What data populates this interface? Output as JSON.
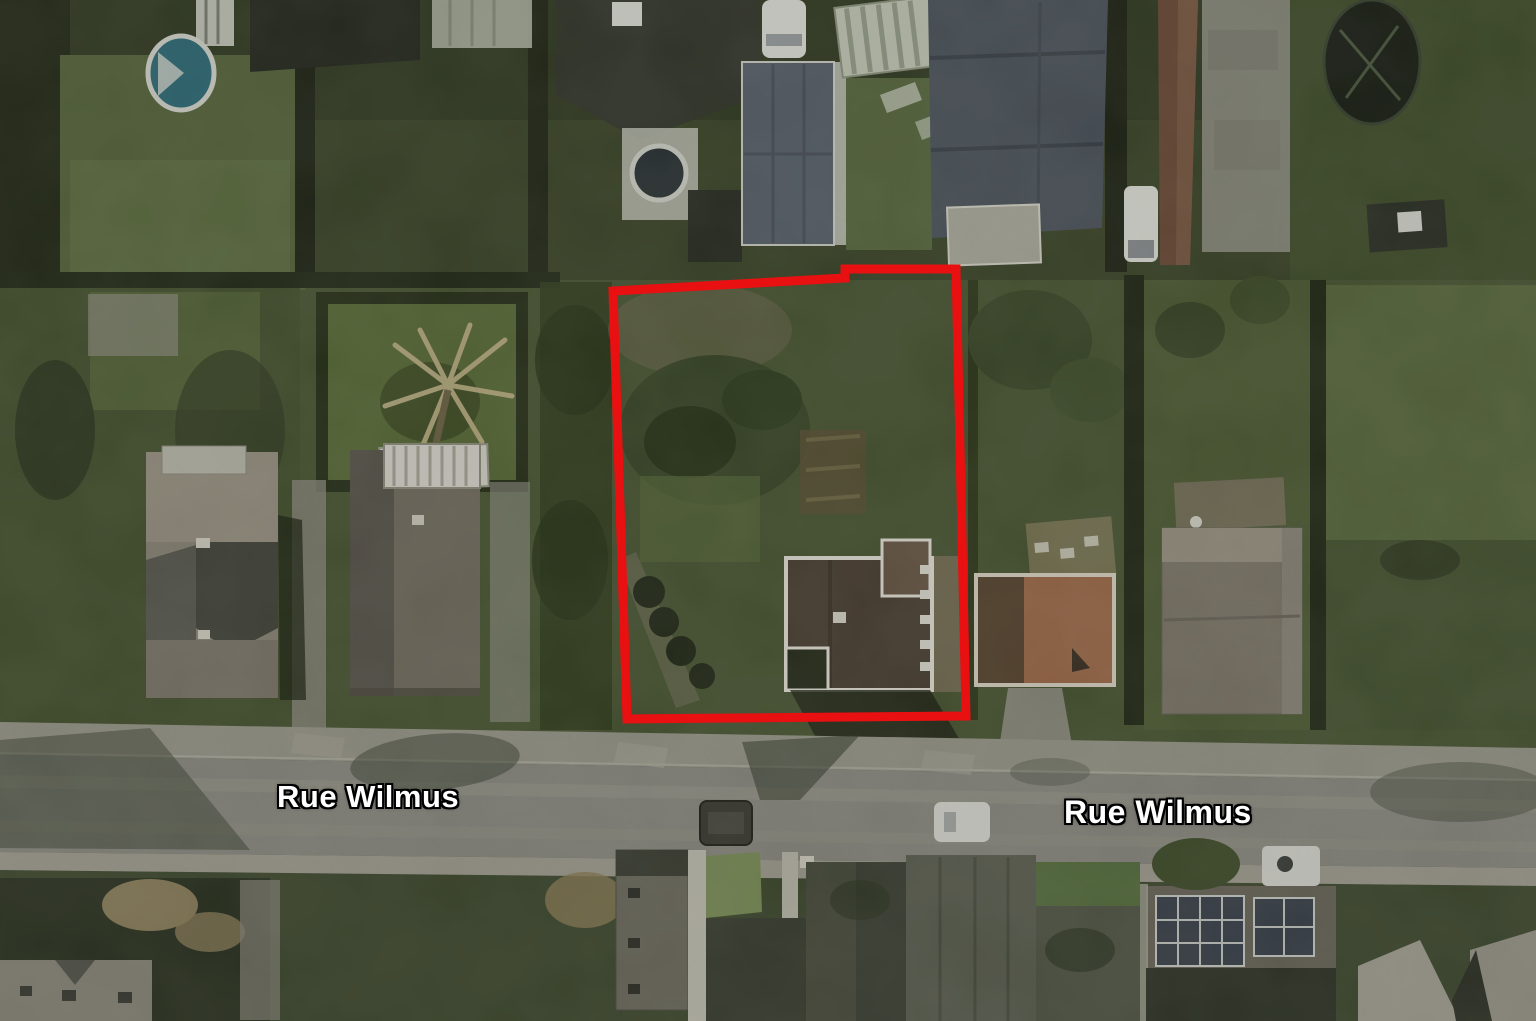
{
  "map": {
    "view_type": "satellite-aerial",
    "location_labels": [
      {
        "id": "west",
        "text": "Rue Wilmus"
      },
      {
        "id": "east",
        "text": "Rue Wilmus"
      }
    ],
    "boundary": {
      "name": "highlighted-property-boundary",
      "points": "613,291 845,278 845,269 956,269 966,716 627,719",
      "color": "#e81010"
    },
    "palette": {
      "boundary_red": "#e81010",
      "label_text": "#ffffff",
      "label_outline": "#000000",
      "road_gray": "#8c8c83",
      "sidewalk_gray": "#9a998c",
      "grass_green": "#4a5733",
      "hedge_dark_green": "#242c18",
      "terracotta_roof": "#a06c4a",
      "slate_roof": "#4d555d",
      "pool_teal": "#2f6d7a"
    }
  }
}
